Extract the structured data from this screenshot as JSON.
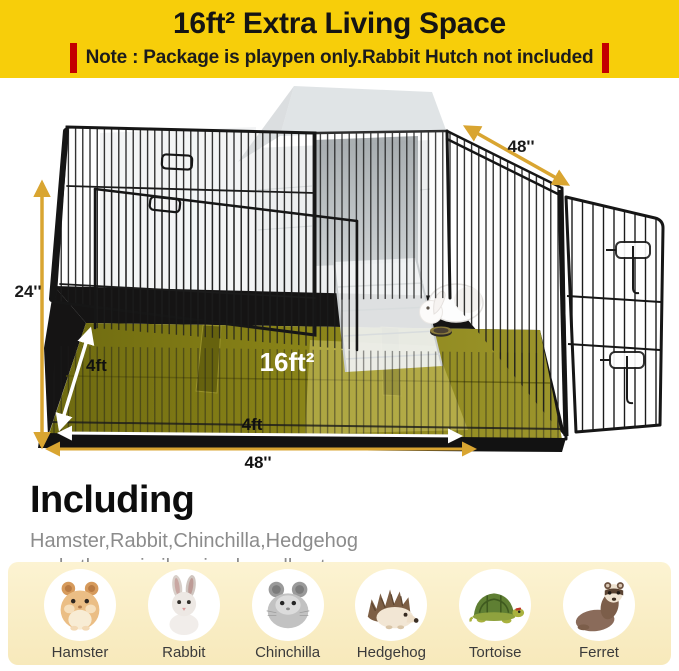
{
  "header": {
    "title": "16ft² Extra Living Space",
    "note": "Note : Package is playpen only.Rabbit Hutch not included"
  },
  "figure": {
    "dim_height": "24''",
    "dim_panel": "48''",
    "dim_depth": "4ft",
    "dim_front": "4ft",
    "dim_width": "48''",
    "dim_area": "16ft²"
  },
  "including": {
    "heading": "Including",
    "line1": "Hamster,Rabbit,Chinchilla,Hedgehog",
    "line2": "and others similar sized small pets"
  },
  "pets": [
    {
      "name": "Hamster",
      "icon": "hamster-icon"
    },
    {
      "name": "Rabbit",
      "icon": "rabbit-icon"
    },
    {
      "name": "Chinchilla",
      "icon": "chinchilla-icon"
    },
    {
      "name": "Hedgehog",
      "icon": "hedgehog-icon"
    },
    {
      "name": "Tortoise",
      "icon": "tortoise-icon"
    },
    {
      "name": "Ferret",
      "icon": "ferret-icon"
    }
  ],
  "colors": {
    "banner_yellow": "#F7CE0A",
    "note_red": "#C40000",
    "arrow_gold": "#D9A531",
    "mat_olive": "#8A8418",
    "panel_cream": "#FAEFC8",
    "wire_black": "#1B1B1B"
  }
}
